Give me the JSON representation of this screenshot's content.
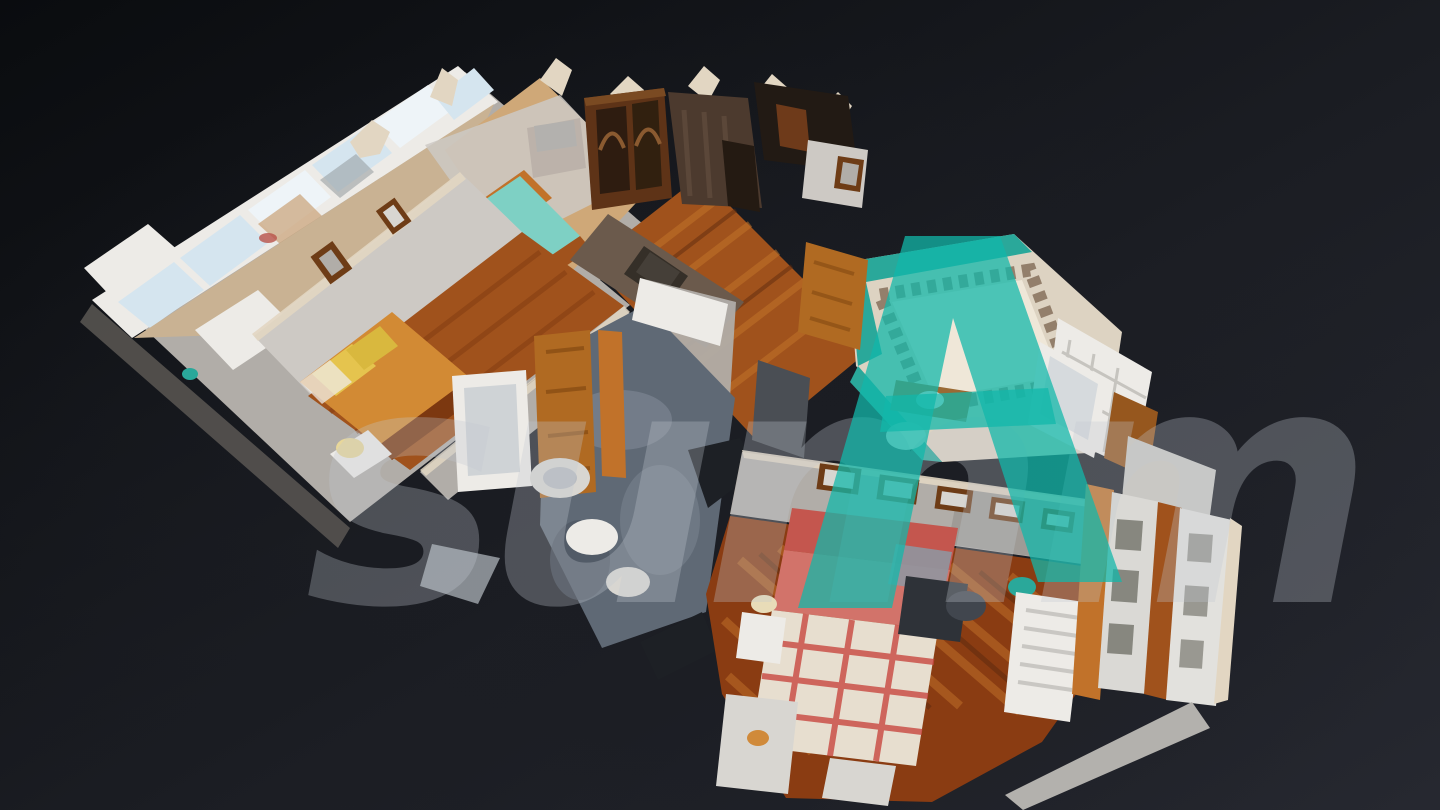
{
  "app": {
    "name": "3D dollhouse tour viewer",
    "view_mode": "dollhouse",
    "description": "Top-down oblique dollhouse view of a photogrammetry-scanned apartment floating on a dark background"
  },
  "watermark": {
    "script_text": "summ",
    "monogram": "A",
    "monogram_style": "flat-top triangle A with crossbar",
    "text_color": "#c3c9d1",
    "monogram_color": "#12b7aa"
  },
  "scene": {
    "rooms": [
      {
        "name": "sunroom-gallery",
        "features": [
          "window wall with sky and city view",
          "desk",
          "office chair"
        ]
      },
      {
        "name": "bedroom-teal",
        "features": [
          "teal bedspread",
          "white pillow",
          "wood headboard",
          "tv sideboard"
        ]
      },
      {
        "name": "bedroom-orange",
        "features": [
          "orange bed",
          "yellow pillows",
          "nightstand lamp",
          "framed pictures"
        ]
      },
      {
        "name": "entry-hall",
        "features": [
          "dark marble wall",
          "mirror",
          "china display cabinet"
        ]
      },
      {
        "name": "hallway",
        "features": [
          "hardwood floor",
          "wooden doors"
        ]
      },
      {
        "name": "bathroom-marble",
        "features": [
          "gray marble floor",
          "bathtub",
          "round sink",
          "toilet",
          "bidet"
        ]
      },
      {
        "name": "bathroom-teal",
        "features": [
          "teal tile floor",
          "ornate tile border",
          "white tiled wall",
          "bathtub",
          "wood vanity"
        ]
      },
      {
        "name": "bedroom-red",
        "features": [
          "red plaid bed",
          "picture frame row",
          "radiator dresser",
          "desk",
          "courtyard windows"
        ]
      }
    ]
  },
  "palette": {
    "bg_dark": "#0a0c0f",
    "bg_mid": "#1b1d23",
    "bg_light": "#262830",
    "wall_light": "#cdc9c4",
    "wall_mid": "#b1ada8",
    "wall_dark": "#908c87",
    "wall_shadow": "#565350",
    "wall_top_cream": "#e2d6c2",
    "fixture_white": "#edebe7",
    "fixture_white_dim": "#d8d6d1",
    "window_sky": "#d5e5ef",
    "window_sky_bright": "#eef4f8",
    "wood_bright": "#c1722a",
    "wood_mid": "#a0521c",
    "wood_dark": "#7c3810",
    "wood_deep": "#5e2a0e",
    "wood_door": "#b06a22",
    "wood_furniture": "#5e3317",
    "marble_gray": "#5f6975",
    "marble_light": "#8b95a1",
    "tile_teal": "#2aa89a",
    "bed_teal": "#7ed0c4",
    "bed_orange": "#d28a34",
    "pillow_yellow": "#e5c44e",
    "bed_red": "#c4564e",
    "bed_pink": "#d2736a",
    "blanket_plaid": "#e7decf",
    "blanket_plaid_red": "#c84840",
    "courtyard_facade": "#dad9d5",
    "courtyard_facade_dark": "#87877f",
    "picture_frame_brown": "#6e3c16",
    "void_dark": "#1d2025",
    "cabinet_gray": "#4a4e54",
    "watermark_gray": "#c3c9d1",
    "watermark_teal": "#12b7aa"
  }
}
